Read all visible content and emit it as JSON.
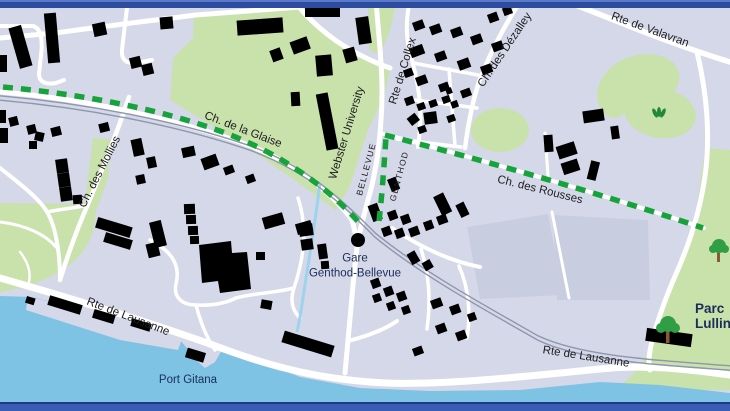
{
  "map": {
    "description": "Street map of Genthod / Bellevue with green dashed route, railway, lake shore and Parc Lullin",
    "colors": {
      "land": "#d5d8e8",
      "building": "#7b86c3",
      "park": "#c9e1ab",
      "water": "#7ec3e4",
      "stream": "#9ed3ee",
      "road": "#ffffff",
      "rail": "#8e96ab",
      "route": "#17a33b",
      "field": "#c9cde0",
      "tree_crown": "#2f9e44",
      "tree_trunk": "#8a5a33",
      "leaf": "#1f8a35",
      "border_top": "#2b4c9f",
      "border_top_light": "#5b79c8",
      "border_bottom": "#3a5cb4",
      "border_bottom_line": "#1c3a8a",
      "street_label": "#1d1d1f",
      "place_label": "#1b2d58"
    },
    "labels": {
      "glaise": "Ch. de la Glaise",
      "mollies": "Ch. des Mollies",
      "webster": "Webster University",
      "bellevue_commune": "BELLEVUE",
      "genthod_commune": "GENTHOD",
      "collex": "Rte de Collex",
      "dezalley": "Ch. des Dézalley",
      "valavran": "Rte de Valavran",
      "rousses": "Ch. des Rousses",
      "lausanne_west": "Rte de Lausanne",
      "lausanne_east": "Rte de Lausanne",
      "station_line1": "Gare",
      "station_line2": "Genthod-Bellevue",
      "port": "Port Gitana",
      "parc_line1": "Parc",
      "parc_line2": "Lullin"
    }
  }
}
